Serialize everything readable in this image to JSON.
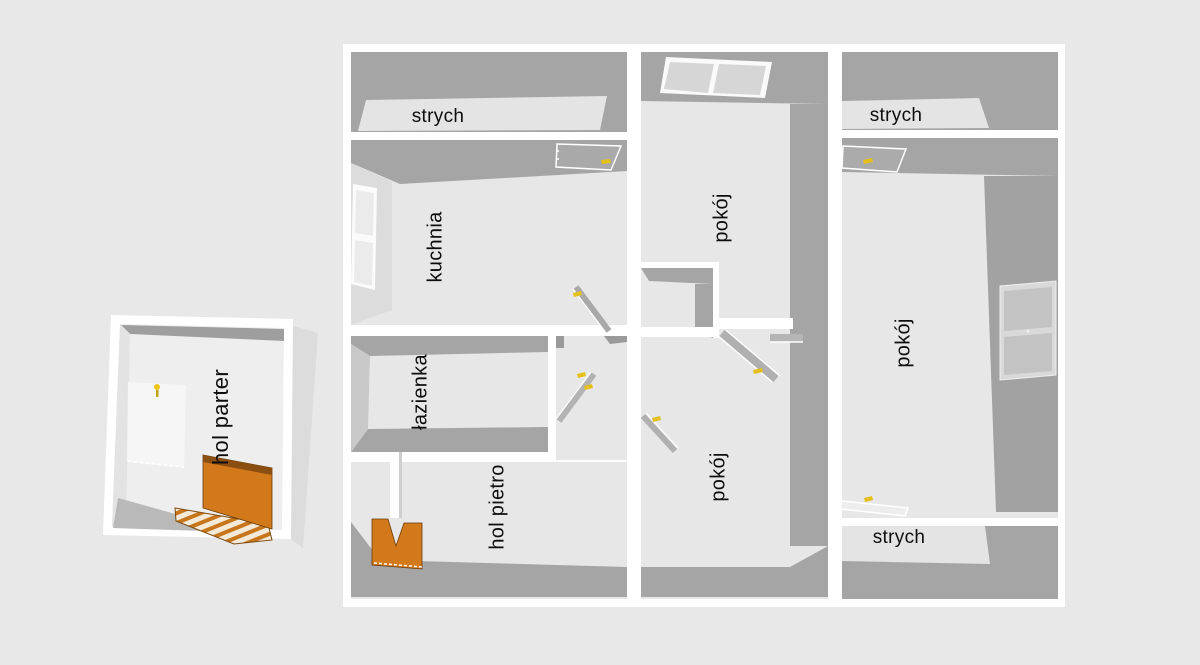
{
  "scene": {
    "type": "3d-floorplan-render",
    "background_color": "#e8e8e8",
    "palette": {
      "wall_outline_white": "#ffffff",
      "wall_dark_gray": "#a5a5a5",
      "floor_light_gray": "#e7e7e7",
      "stairs_orange": "#d2791c",
      "stairs_edge_brown": "#8a4e10",
      "door_handle_yellow": "#e3c01b"
    }
  },
  "rooms": [
    {
      "id": "strych-top-left",
      "label": "strych",
      "orientation": "horizontal"
    },
    {
      "id": "kuchnia",
      "label": "kuchnia",
      "orientation": "vertical"
    },
    {
      "id": "lazienka",
      "label": "łazienka",
      "orientation": "vertical"
    },
    {
      "id": "hol-pietro",
      "label": "hol pietro",
      "orientation": "vertical"
    },
    {
      "id": "pokoj-top-middle",
      "label": "pokój",
      "orientation": "vertical"
    },
    {
      "id": "pokoj-bottom-middle",
      "label": "pokój",
      "orientation": "vertical"
    },
    {
      "id": "pokoj-right",
      "label": "pokój",
      "orientation": "vertical"
    },
    {
      "id": "strych-top-right",
      "label": "strych",
      "orientation": "horizontal"
    },
    {
      "id": "strych-bottom-right",
      "label": "strych",
      "orientation": "horizontal"
    },
    {
      "id": "hol-parter",
      "label": "hol parter",
      "orientation": "vertical"
    }
  ],
  "features": {
    "staircases": 2,
    "skylight_panes": 2,
    "wall_windows": 2,
    "open_doors_with_yellow_handles": 7,
    "ceiling_lamp_symbols": 1
  }
}
